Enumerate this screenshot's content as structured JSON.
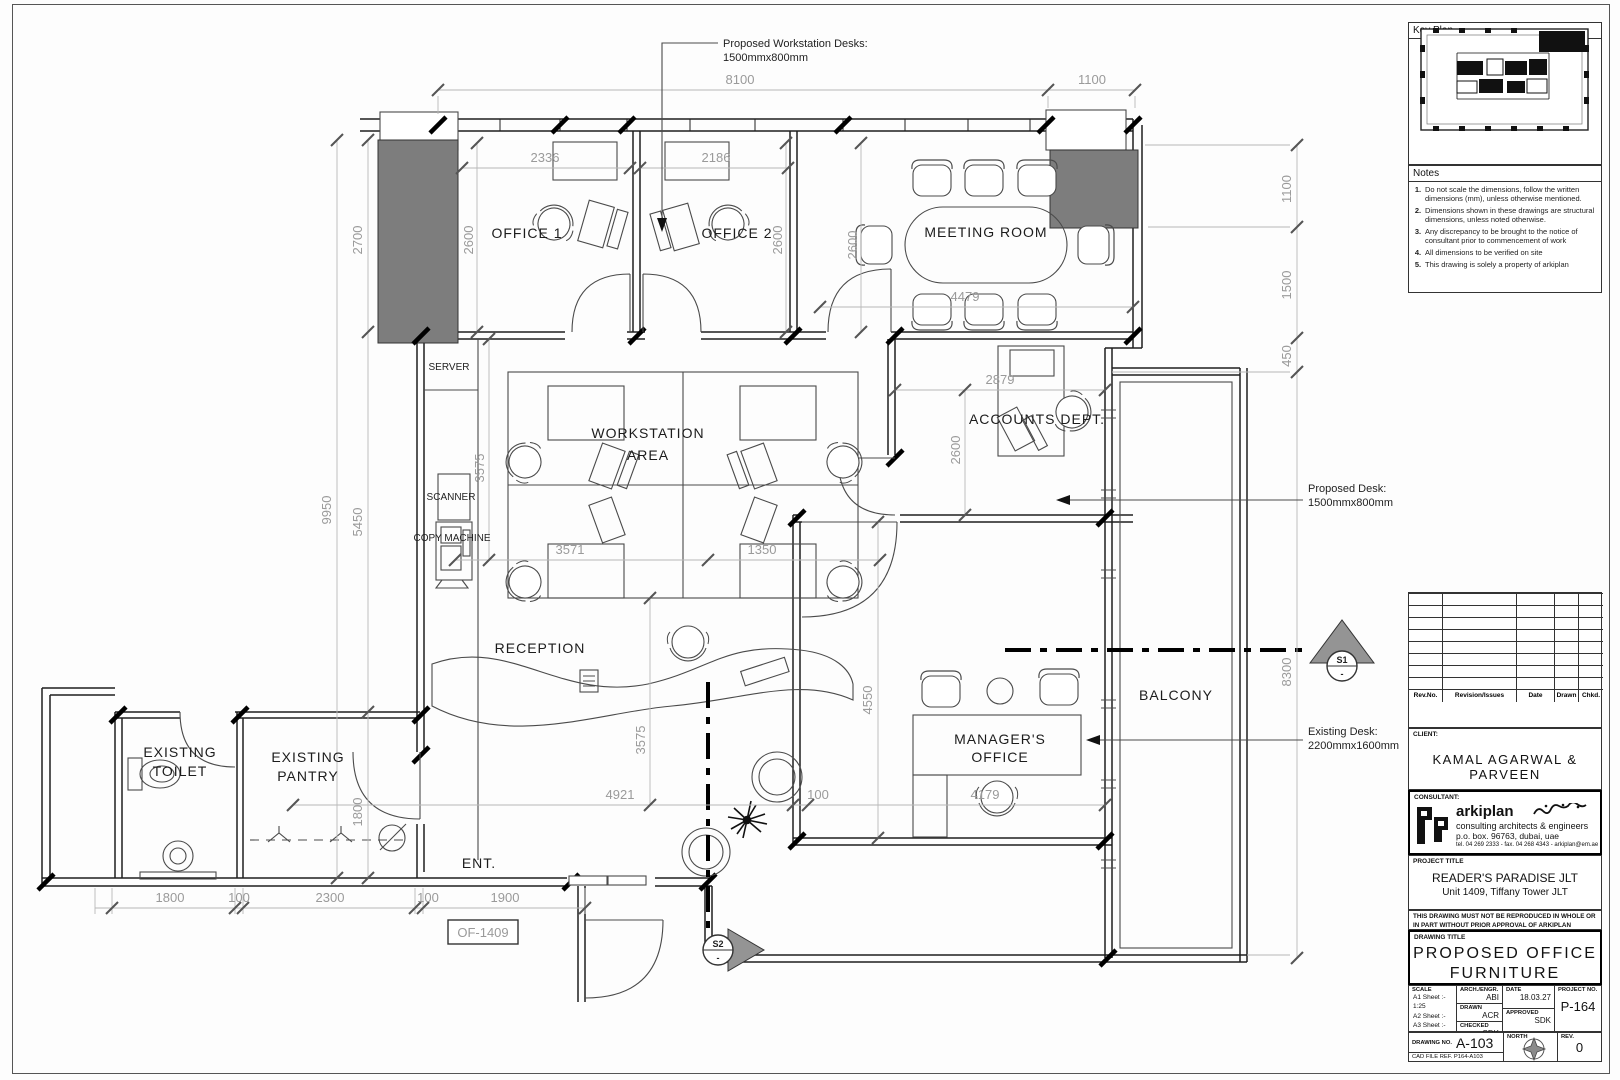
{
  "panel": {
    "key_plan_title": "Key Plan",
    "notes_title": "Notes",
    "notes": [
      {
        "num": "1.",
        "text": "Do not scale the dimensions, follow the written dimensions (mm), unless otherwise mentioned."
      },
      {
        "num": "2.",
        "text": "Dimensions shown in these drawings are structural dimensions, unless noted otherwise."
      },
      {
        "num": "3.",
        "text": "Any discrepancy to be brought to the notice of consultant prior to commencement of work"
      },
      {
        "num": "4.",
        "text": "All dimensions to be verified on site"
      },
      {
        "num": "5.",
        "text": "This drawing is solely a property of arkiplan"
      }
    ],
    "rev_header": {
      "rev_no": "Rev.No.",
      "issue": "Revision/Issues",
      "date": "Date",
      "drawn": "Drawn",
      "chkd": "Chkd."
    },
    "client_label": "CLIENT:",
    "client_name": "KAMAL AGARWAL & PARVEEN",
    "consultant_label": "CONSULTANT:",
    "consultant": {
      "name": "arkiplan",
      "tagline": "consulting architects & engineers",
      "address": "p.o. box. 96763,     dubai,     uae",
      "contact": "tel. 04 269 2333 - fax. 04 268 4343 - arkiplan@em.ae"
    },
    "project_label": "PROJECT TITLE",
    "project_name": "READER'S PARADISE JLT",
    "project_unit": "Unit 1409, Tiffany Tower JLT",
    "disclaimer_1": "THIS DRAWING MUST NOT BE REPRODUCED IN WHOLE OR",
    "disclaimer_2": "IN PART WITHOUT PRIOR APPROVAL OF ARKIPLAN",
    "drawing_title_label": "DRAWING TITLE",
    "drawing_title_1": "PROPOSED OFFICE",
    "drawing_title_2": "FURNITURE LAYOUT",
    "scale_label": "SCALE",
    "scale_a1": "A1 Sheet :- 1:25",
    "scale_a2": "A2 Sheet :-",
    "scale_a3": "A3 Sheet :- 1:50",
    "arch_label": "ARCH./ENGR.",
    "arch_value": "ABI",
    "drawn_label": "DRAWN",
    "drawn_value": "ACR",
    "checked_label": "CHECKED",
    "checked_value": "SDK",
    "date_label": "DATE",
    "date_value": "18.03.27",
    "approved_label": "APPROVED",
    "approved_value": "SDK",
    "project_no_label": "PROJECT NO.",
    "project_no": "P-164",
    "drawing_no_label": "DRAWING NO.",
    "drawing_no": "A-103",
    "north_label": "NORTH",
    "rev_label": "REV.",
    "rev_value": "0",
    "cad_ref": "CAD FILE REF. P164-A103"
  },
  "plan": {
    "rooms": {
      "office1": "OFFICE 1",
      "office2": "OFFICE 2",
      "meeting": "MEETING ROOM",
      "workstation_1": "WORKSTATION",
      "workstation_2": "AREA",
      "accounts": "ACCOUNTS DEPT.",
      "reception": "RECEPTION",
      "manager_1": "MANAGER'S",
      "manager_2": "OFFICE",
      "balcony": "BALCONY",
      "toilet_1": "EXISTING",
      "toilet_2": "TOILET",
      "pantry_1": "EXISTING",
      "pantry_2": "PANTRY",
      "entrance": "ENT."
    },
    "equipment": {
      "server": "SERVER",
      "scanner": "SCANNER",
      "copy_machine": "COPY MACHINE"
    },
    "annotations": {
      "workstation_desks_1": "Proposed Workstation Desks:",
      "workstation_desks_2": "1500mmx800mm",
      "proposed_desk_1": "Proposed Desk:",
      "proposed_desk_2": "1500mmx800mm",
      "existing_desk_1": "Existing Desk:",
      "existing_desk_2": "2200mmx1600mm",
      "unit_tag": "OF-1409"
    },
    "markers": {
      "s1": "S1",
      "s2": "S2",
      "sub": "-"
    },
    "dims": {
      "d8100": "8100",
      "d1100_top": "1100",
      "d2336": "2336",
      "d2186": "2186",
      "d2600_o1": "2600",
      "d2600_o2": "2600",
      "d2600_mr": "2600",
      "d2600_ac": "2600",
      "d2700": "2700",
      "d9950": "9950",
      "d5450": "5450",
      "d1800_pantry": "1800",
      "d3575_ws": "3575",
      "d3571": "3571",
      "d1350": "1350",
      "d3575_rc": "3575",
      "d2879": "2879",
      "d4479": "4479",
      "d4550": "4550",
      "d4921": "4921",
      "d100_mid": "100",
      "d4179": "4179",
      "d1100_r": "1100",
      "d1500_r": "1500",
      "d450_r": "450",
      "d8300": "8300",
      "d1800_b": "1800",
      "d100_b1": "100",
      "d2300_b": "2300",
      "d100_b2": "100",
      "d1900_b": "1900"
    }
  }
}
